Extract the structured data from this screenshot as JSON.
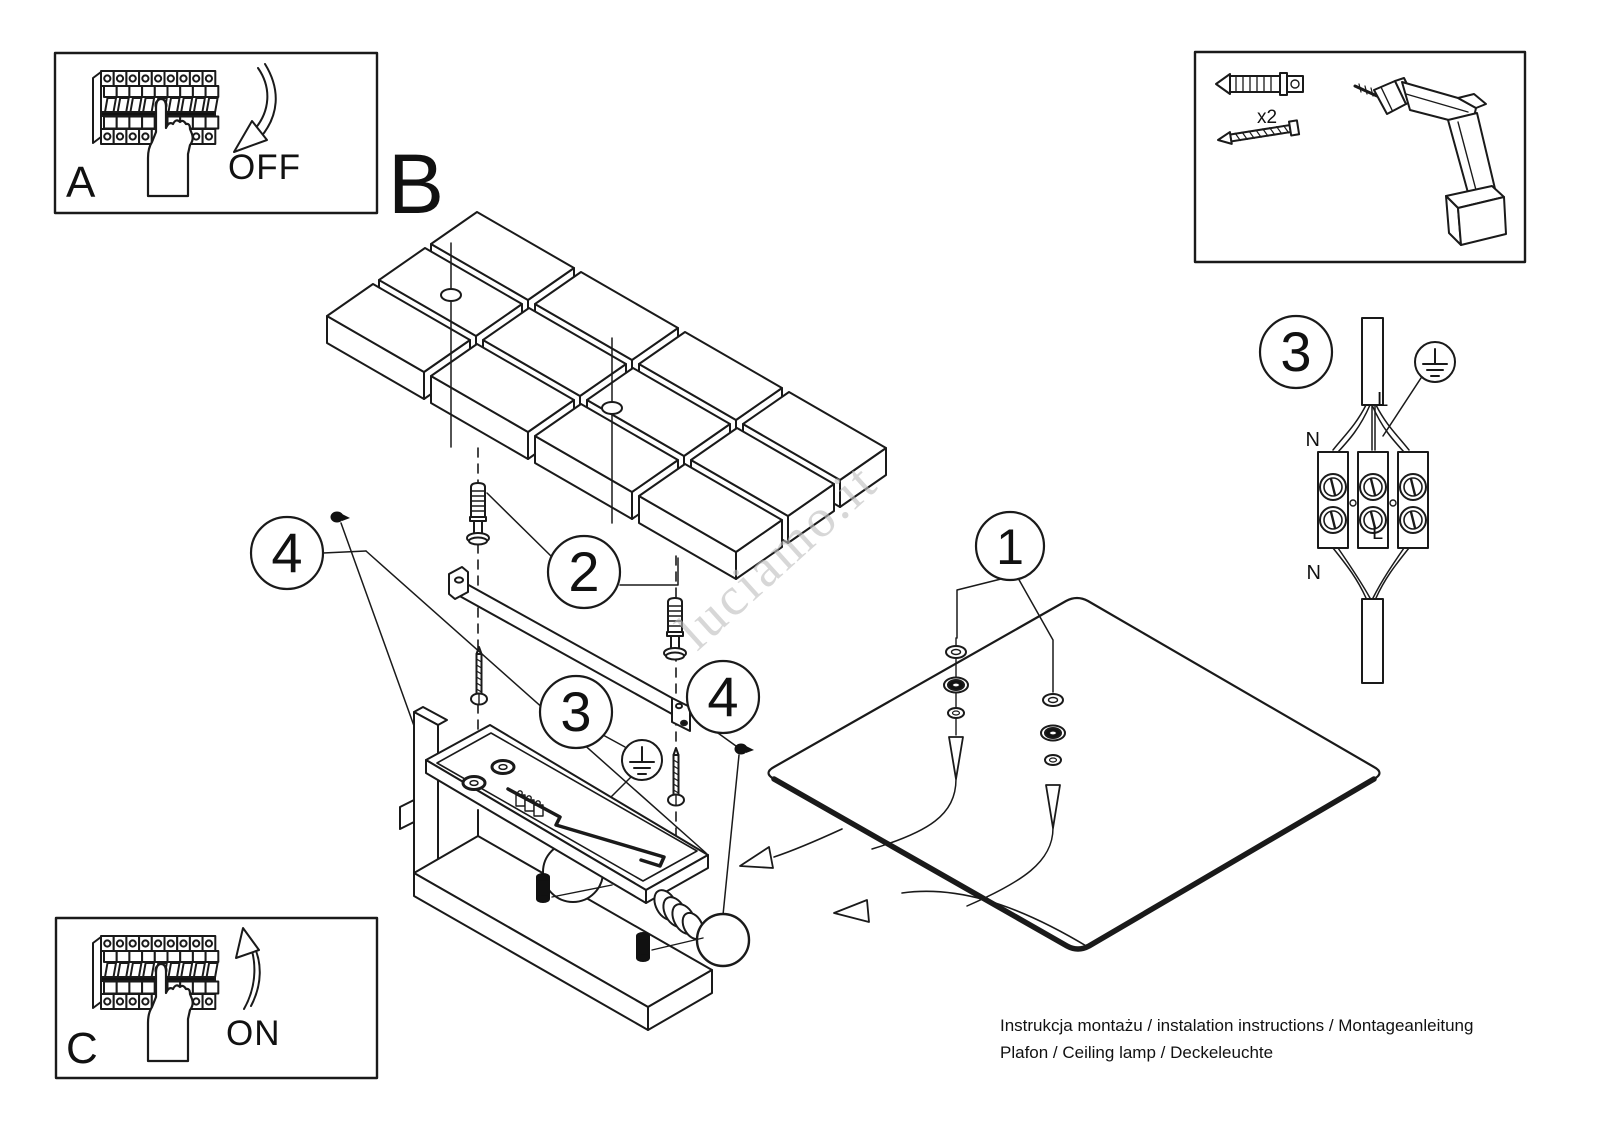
{
  "labels": {
    "a": "A",
    "b": "B",
    "c": "C",
    "off": "OFF",
    "on": "ON"
  },
  "tools": {
    "anchor_quantity": "x2"
  },
  "markers": {
    "glass": "1",
    "anchors": "2",
    "earth": "3",
    "earth_wiring": "3",
    "screw_left": "4",
    "screw_right": "4"
  },
  "wiring": {
    "n_top": "N",
    "l_top": "L",
    "l_mid": "L",
    "n_bottom": "N"
  },
  "watermark": "luciamo.it",
  "footer": {
    "line1": "Instrukcja montażu / instalation instructions / Montageanleitung",
    "line2": "Plafon / Ceiling lamp / Deckeleuchte"
  },
  "colors": {
    "line": "#1a1a1a",
    "watermark": "#bdbdbd",
    "background": "#ffffff"
  }
}
